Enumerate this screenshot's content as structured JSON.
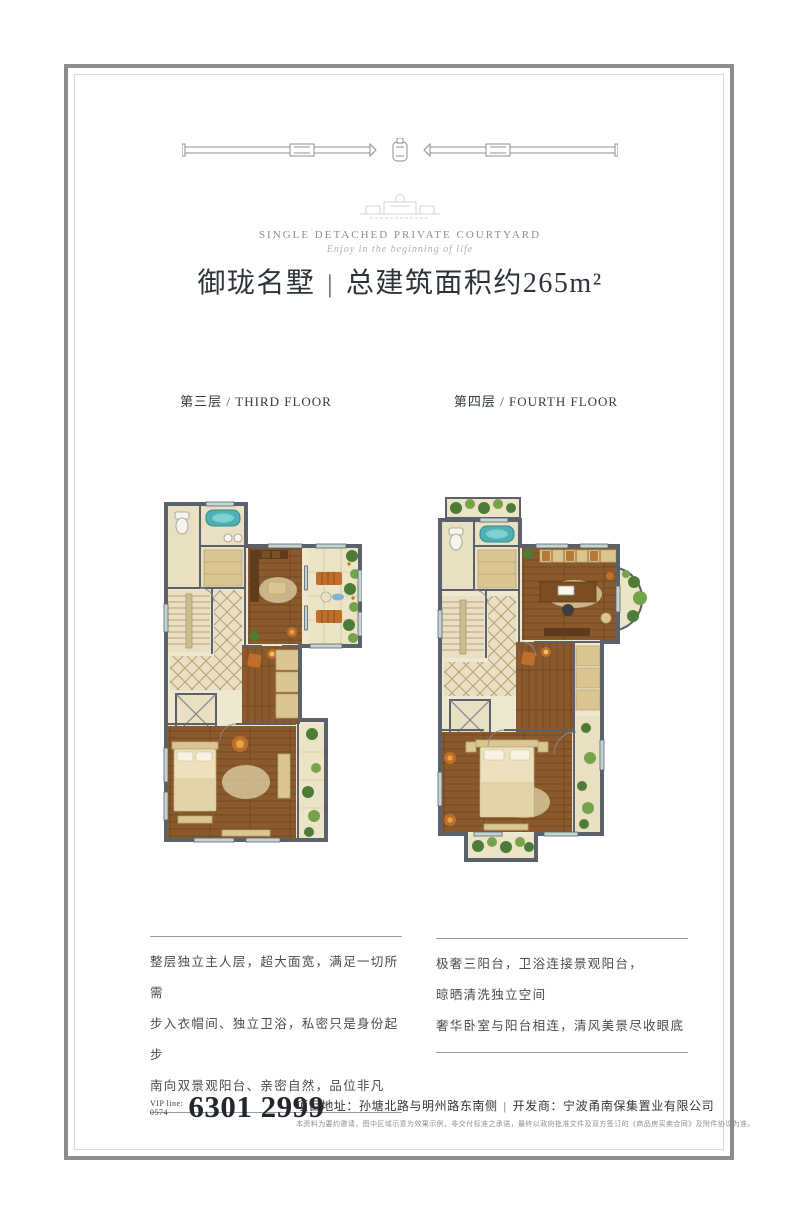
{
  "brand": {
    "caption": "SINGLE DETACHED PRIVATE COURTYARD",
    "tagline": "Enjoy in the beginning of life"
  },
  "title": {
    "name": "御珑名墅",
    "separator": "|",
    "area": "总建筑面积约265m²"
  },
  "floors": [
    {
      "label": "第三层 / THIRD FLOOR",
      "desc_lines": [
        "整层独立主人层，超大面宽，满足一切所需",
        "步入衣帽间、独立卫浴，私密只是身份起步",
        "南向双景观阳台、亲密自然，品位非凡"
      ]
    },
    {
      "label": "第四层 / FOURTH FLOOR",
      "desc_lines": [
        "极奢三阳台，卫浴连接景观阳台，",
        "晾晒清洗独立空间",
        "奢华卧室与阳台相连，清风美景尽收眼底"
      ]
    }
  ],
  "footer": {
    "phone_label": "VIP line:",
    "phone_area": "0574",
    "phone_number": "6301 2999",
    "address_label": "项目地址：",
    "address": "孙塘北路与明州路东南侧",
    "separator": "|",
    "developer_label": "开发商：",
    "developer": "宁波甬南保集置业有限公司",
    "disclaimer": "本资料为要约邀请，图中区域示意为效果示例，非交付标准之承诺，最终以政府批准文件及双方签订的《商品房买卖合同》及附件协议为准。"
  },
  "colors": {
    "frame_border": "#8d8d8d",
    "wall": "#5a616b",
    "wood": "#8a5a2c",
    "wood_dark": "#6b431f",
    "tile": "#e9e0c4",
    "tile_line": "#b3a072",
    "tan": "#d9c692",
    "plant": "#4d7c38",
    "plant_light": "#76a24c",
    "tub": "#4fb0b4",
    "orange": "#c06e2c",
    "balcony": "#ece4c6"
  }
}
